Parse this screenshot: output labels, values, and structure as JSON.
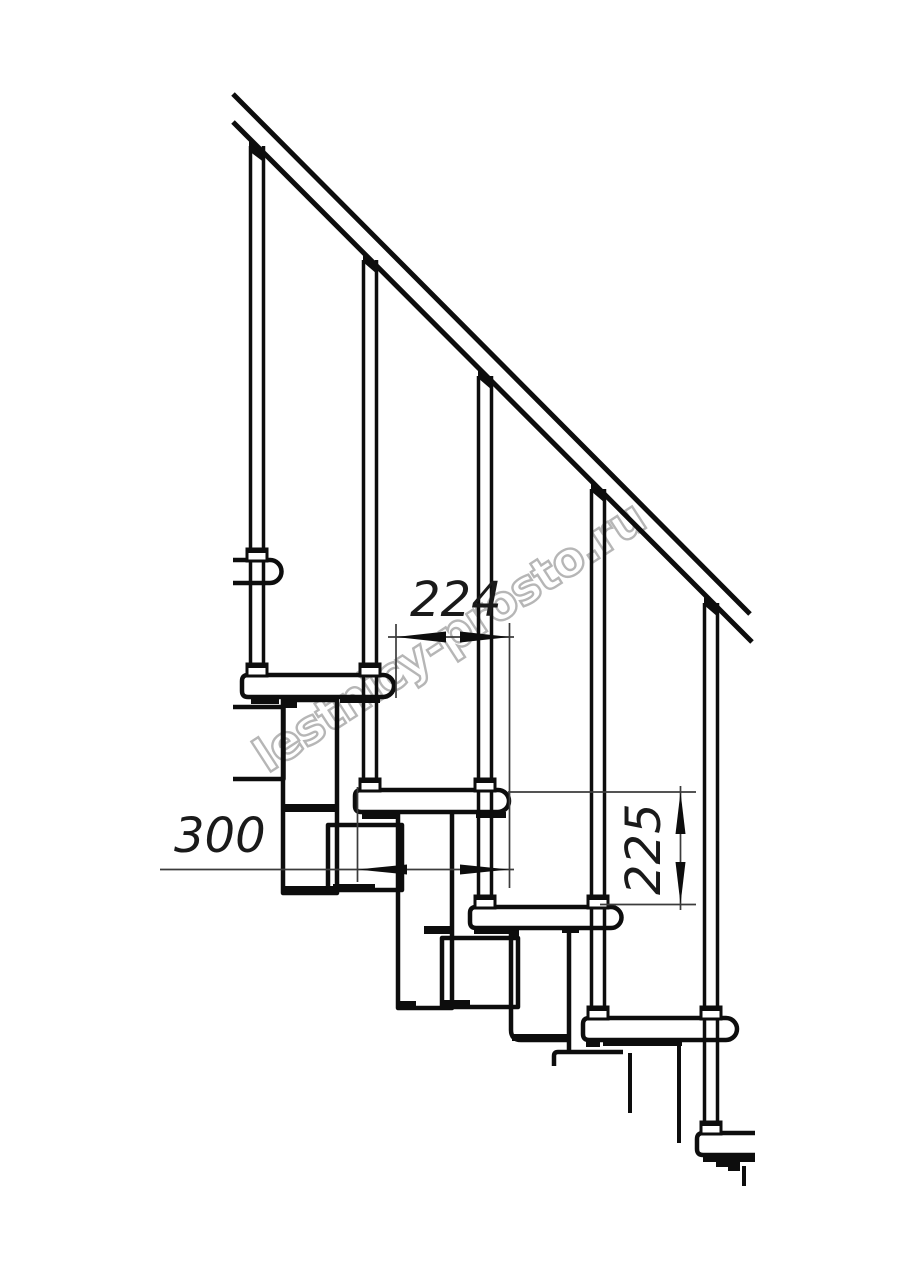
{
  "drawing": {
    "watermark": {
      "text": "lestnicy-prosto.ru",
      "color": "#b3b3b3"
    },
    "colors": {
      "line": "#0d0d0d",
      "dimension": "#3c3c3c",
      "background": "#ffffff"
    },
    "dimensions": {
      "run": {
        "value": "224",
        "orientation": "horizontal"
      },
      "depth": {
        "value": "300",
        "orientation": "horizontal"
      },
      "rise": {
        "value": "225",
        "orientation": "vertical"
      }
    }
  }
}
